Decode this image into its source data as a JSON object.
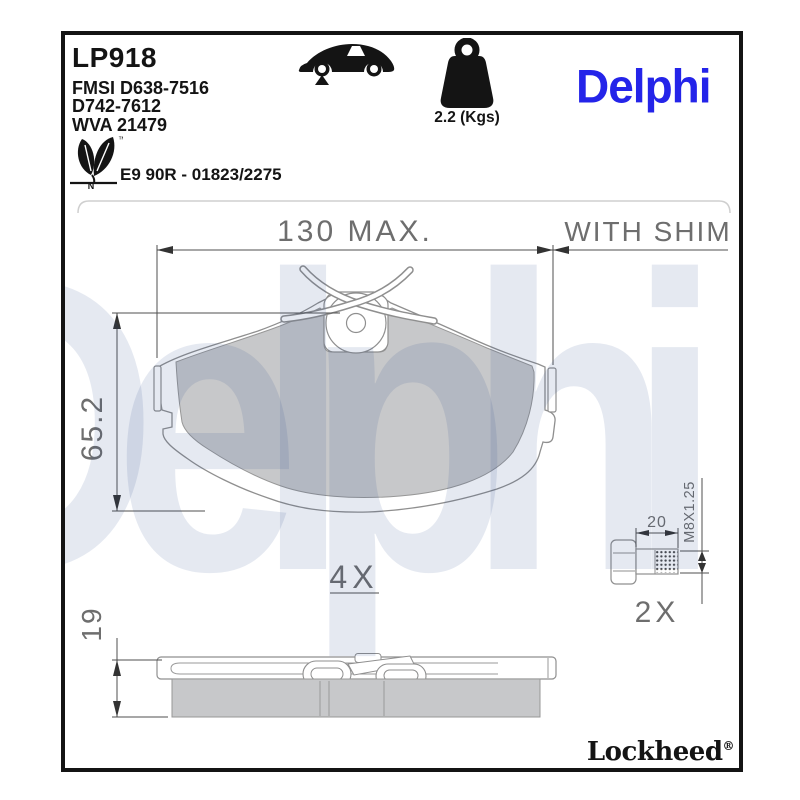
{
  "sheet": {
    "border_color": "#141414",
    "background": "#ffffff"
  },
  "header": {
    "part_number": "LP918",
    "fmsi_line1": "FMSI D638-7516",
    "fmsi_line2": "D742-7612",
    "wva_line": "WVA 21479",
    "approval_line": "E9 90R - 01823/2275",
    "eco_trademark": "™",
    "eco_letter": "N",
    "vehicle_icon": "car-side-silhouette-with-front-axle-marker",
    "weight_icon": "kettlebell-weight",
    "weight_label": "2.2 (Kgs)",
    "brand_logo_text": "Delphi",
    "brand_color": "#2424e9"
  },
  "drawing": {
    "front_view": {
      "width_dim_label": "130 MAX.",
      "shim_note": "WITH SHIM",
      "height_dim_label": "65.2",
      "quantity_label": "4X"
    },
    "side_view": {
      "thickness_dim_label": "19"
    },
    "bolt": {
      "length_dim_label": "20",
      "thread_spec_label": "M8X1.25",
      "quantity_label": "2X"
    },
    "colors": {
      "friction_fill": "#c7c8ca",
      "outline": "#8f8f8f",
      "dimension_line": "#4f4f4f",
      "dimension_text": "#6e6e6e"
    }
  },
  "watermark": {
    "text": "Delphi"
  },
  "footer": {
    "brand_text": "Lockheed",
    "registered_mark": "®"
  }
}
